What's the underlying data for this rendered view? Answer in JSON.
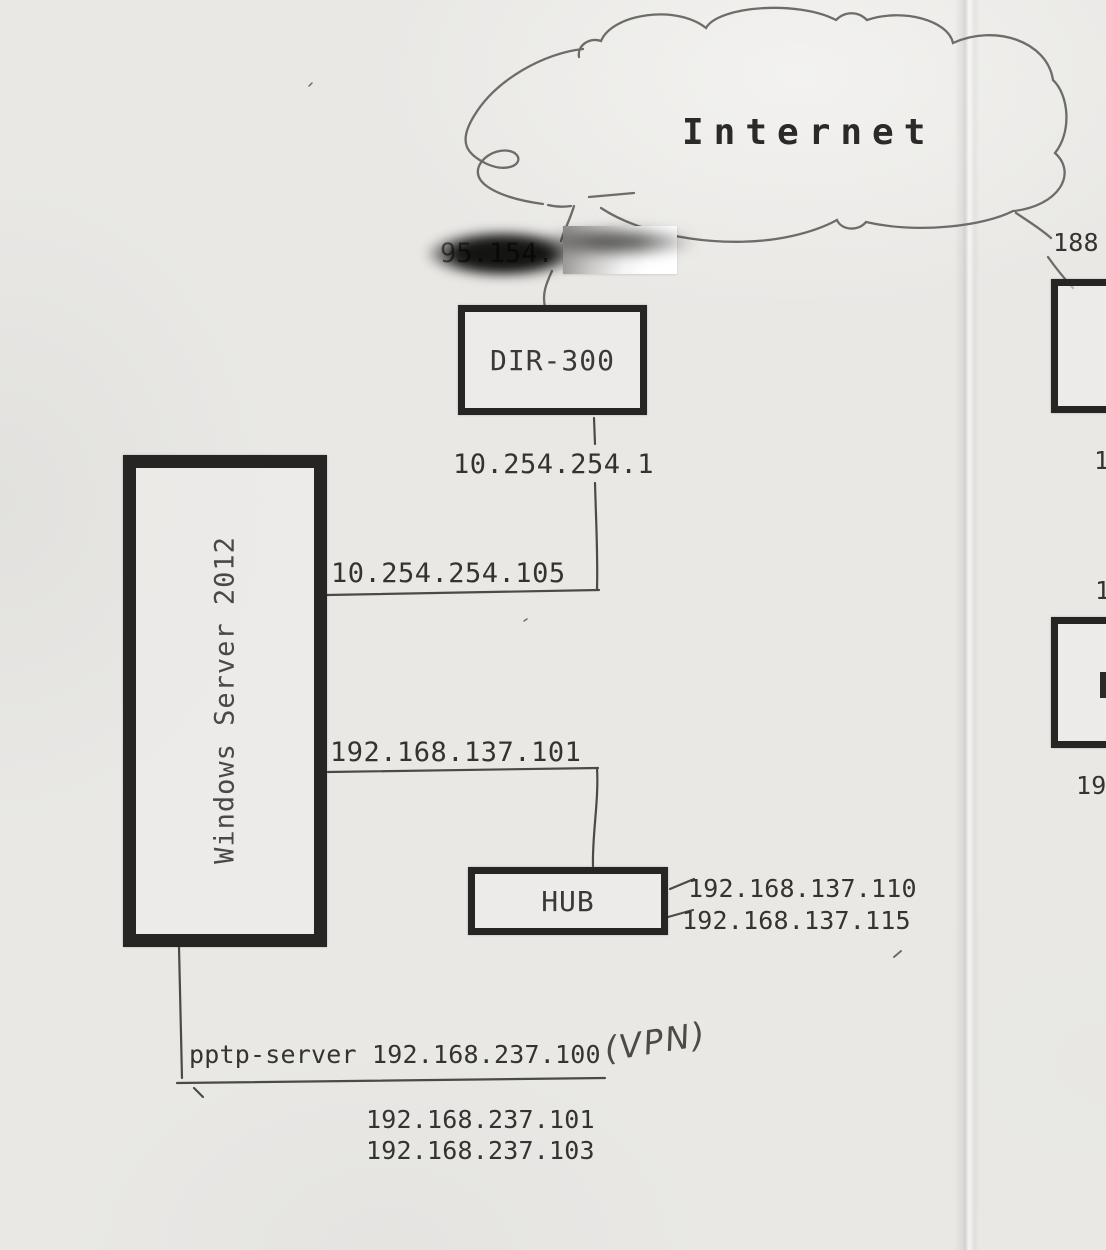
{
  "cloud": {
    "label": "Internet"
  },
  "wan": {
    "redacted_ip_prefix": "95.154."
  },
  "devices": {
    "router": {
      "label": "DIR-300",
      "lan_ip": "10.254.254.1"
    },
    "server": {
      "label": "Windows Server 2012",
      "uplink_ip": "10.254.254.105",
      "lan_ip": "192.168.137.101"
    },
    "hub": {
      "label": "HUB",
      "clients": [
        "192.168.137.110",
        "192.168.137.115"
      ]
    },
    "pptp": {
      "label": "pptp-server 192.168.237.100",
      "note": "(VPN)",
      "clients": [
        "192.168.237.101",
        "192.168.237.103"
      ]
    }
  },
  "right_edge": {
    "isp_prefix": "188",
    "partial_1": "1",
    "partial_2": "1",
    "partial_3": "19"
  },
  "colors": {
    "paper": "#e9e8e5",
    "pen_ink": "#6e6c68",
    "print_ink": "#2e2d2b",
    "box_border": "#262523",
    "redaction_black": "#141413",
    "redaction_white": "#ffffff"
  }
}
